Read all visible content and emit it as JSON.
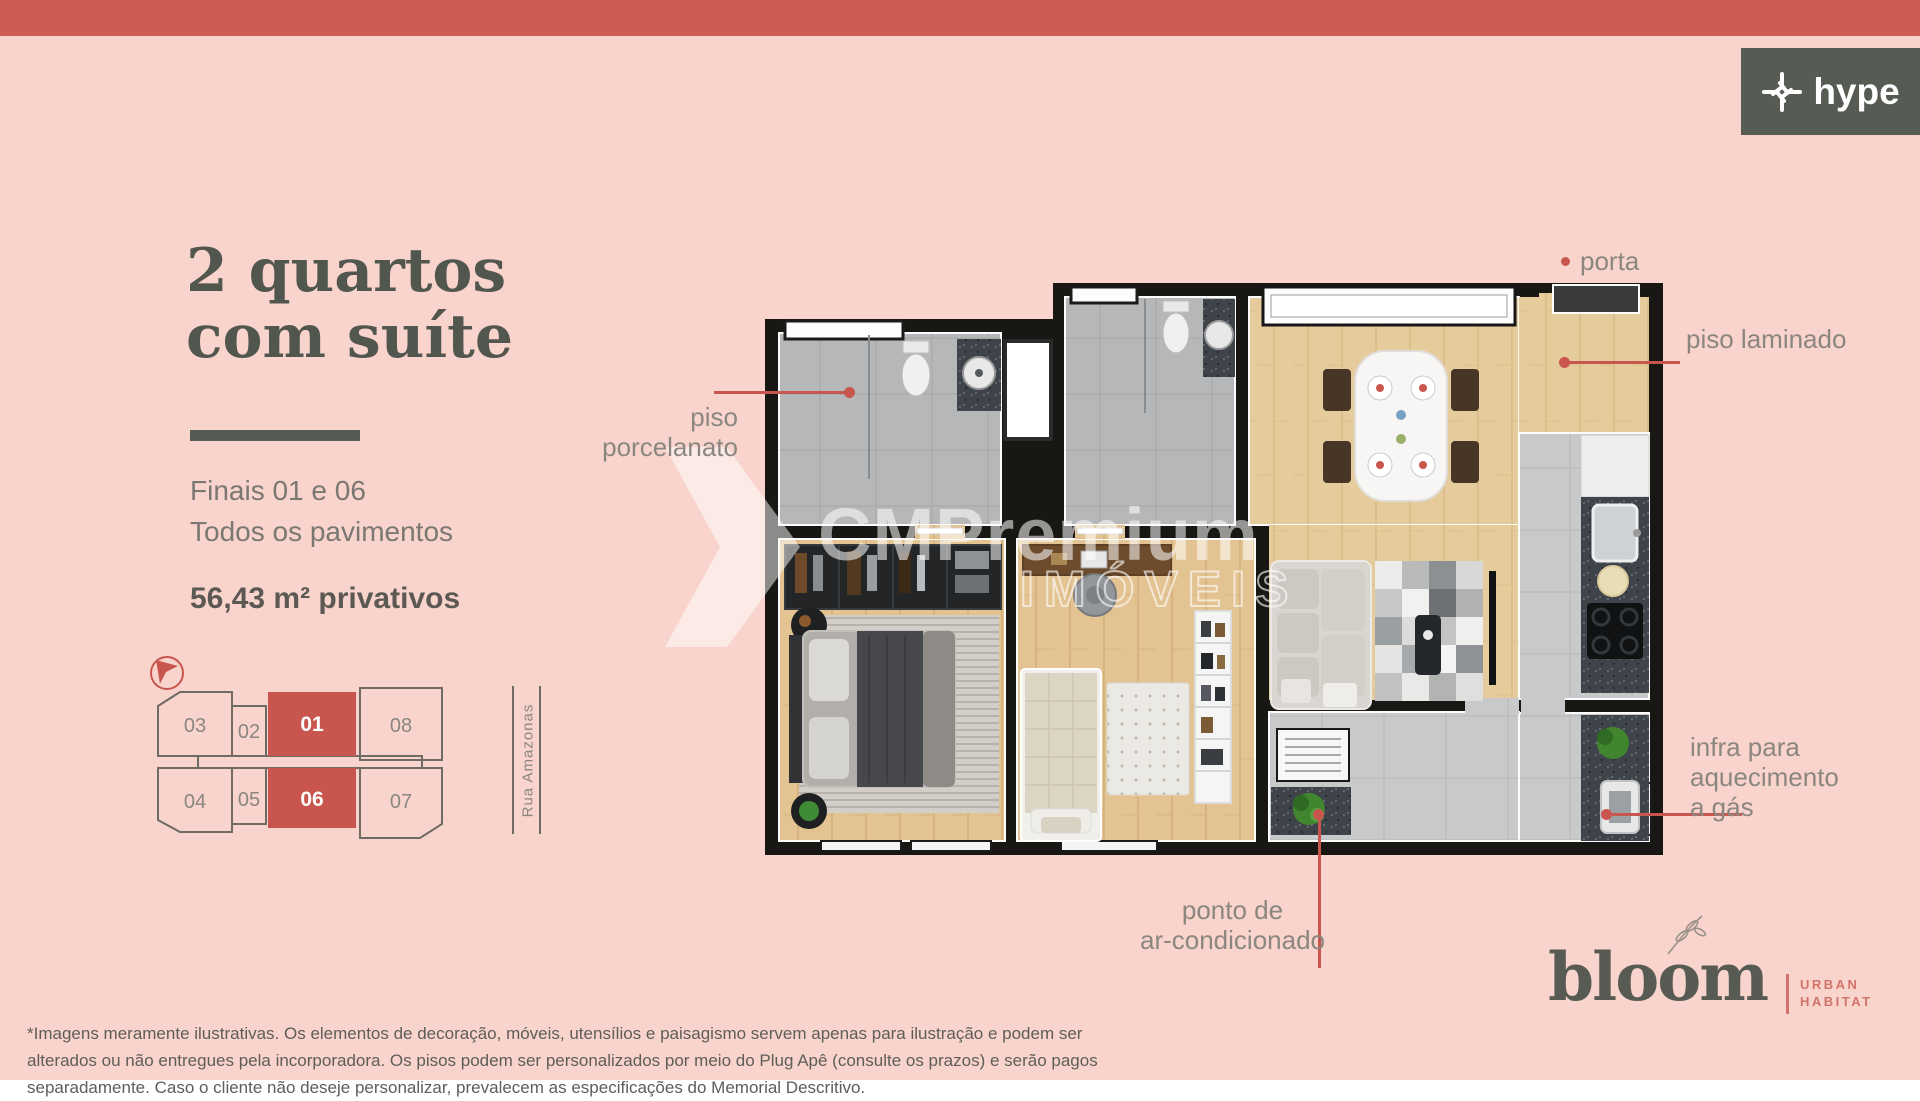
{
  "page": {
    "background_color": "#f8d4cc",
    "topbar_color": "#cd5c55",
    "accent_red": "#c9564e",
    "dark_green": "#565b54"
  },
  "brand_hype": {
    "name": "hype"
  },
  "panel": {
    "title_line1": "2 quartos",
    "title_line2": "com suíte",
    "subtitle_line1": "Finais 01 e 06",
    "subtitle_line2": "Todos os pavimentos",
    "area": "56,43 m² privativos"
  },
  "keyplan": {
    "street": "Rua Amazonas",
    "highlight_color": "#c9564e",
    "units": [
      {
        "label": "03",
        "highlighted": false
      },
      {
        "label": "02",
        "highlighted": false
      },
      {
        "label": "01",
        "highlighted": true
      },
      {
        "label": "08",
        "highlighted": false
      },
      {
        "label": "04",
        "highlighted": false
      },
      {
        "label": "05",
        "highlighted": false
      },
      {
        "label": "06",
        "highlighted": true
      },
      {
        "label": "07",
        "highlighted": false
      }
    ]
  },
  "annotations": {
    "color": "#c9564e",
    "label_color": "#8b8780",
    "porta": "porta",
    "piso_laminado": "piso laminado",
    "piso_porcelanato": "piso porcelanato",
    "infra_line1": "infra para",
    "infra_line2": "aquecimento",
    "infra_line3": "a gás",
    "ponto_line1": "ponto de",
    "ponto_line2": "ar-condicionado"
  },
  "watermark": {
    "line1": "CMPremium",
    "line2": "IMÓVEIS"
  },
  "brand_bloom": {
    "name": "bloom",
    "tag_line1": "URBAN",
    "tag_line2": "HABITAT"
  },
  "disclaimer": {
    "line1": "*Imagens meramente ilustrativas. Os elementos de decoração, móveis, utensílios e paisagismo servem apenas para ilustração e podem ser",
    "line2": "alterados ou não entregues pela incorporadora. Os pisos podem ser personalizados por meio do Plug Apê (consulte os prazos) e serão pagos",
    "line3": "separadamente. Caso o cliente não deseje personalizar, prevalecem as especificações do Memorial Descritivo."
  }
}
